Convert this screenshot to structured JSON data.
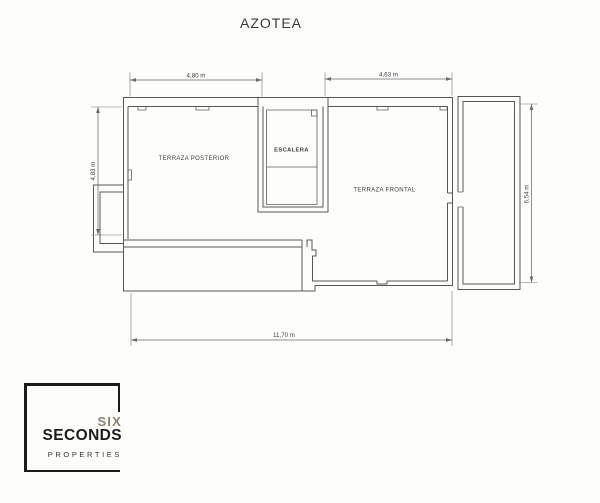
{
  "page": {
    "title": "AZOTEA"
  },
  "plan": {
    "room_labels": {
      "posterior": "TERRAZA POSTERIOR",
      "escalera": "ESCALERA",
      "frontal": "TERRAZA FRONTAL"
    },
    "dimensions": {
      "top_left": "4,80 m",
      "top_right": "4,63 m",
      "left": "4,83 m",
      "right": "6,54 m",
      "bottom": "11,70 m"
    },
    "colors": {
      "wall": "#565656",
      "dimension_line": "#6b6b6b",
      "label_text": "#3e3e3e"
    }
  },
  "logo": {
    "word1": "SIX",
    "word2": "SECONDS",
    "word3": "PROPERTIES",
    "colors": {
      "accent": "#8b8075",
      "dark": "#1c1c1b",
      "frame": "#1b1b1b"
    }
  }
}
